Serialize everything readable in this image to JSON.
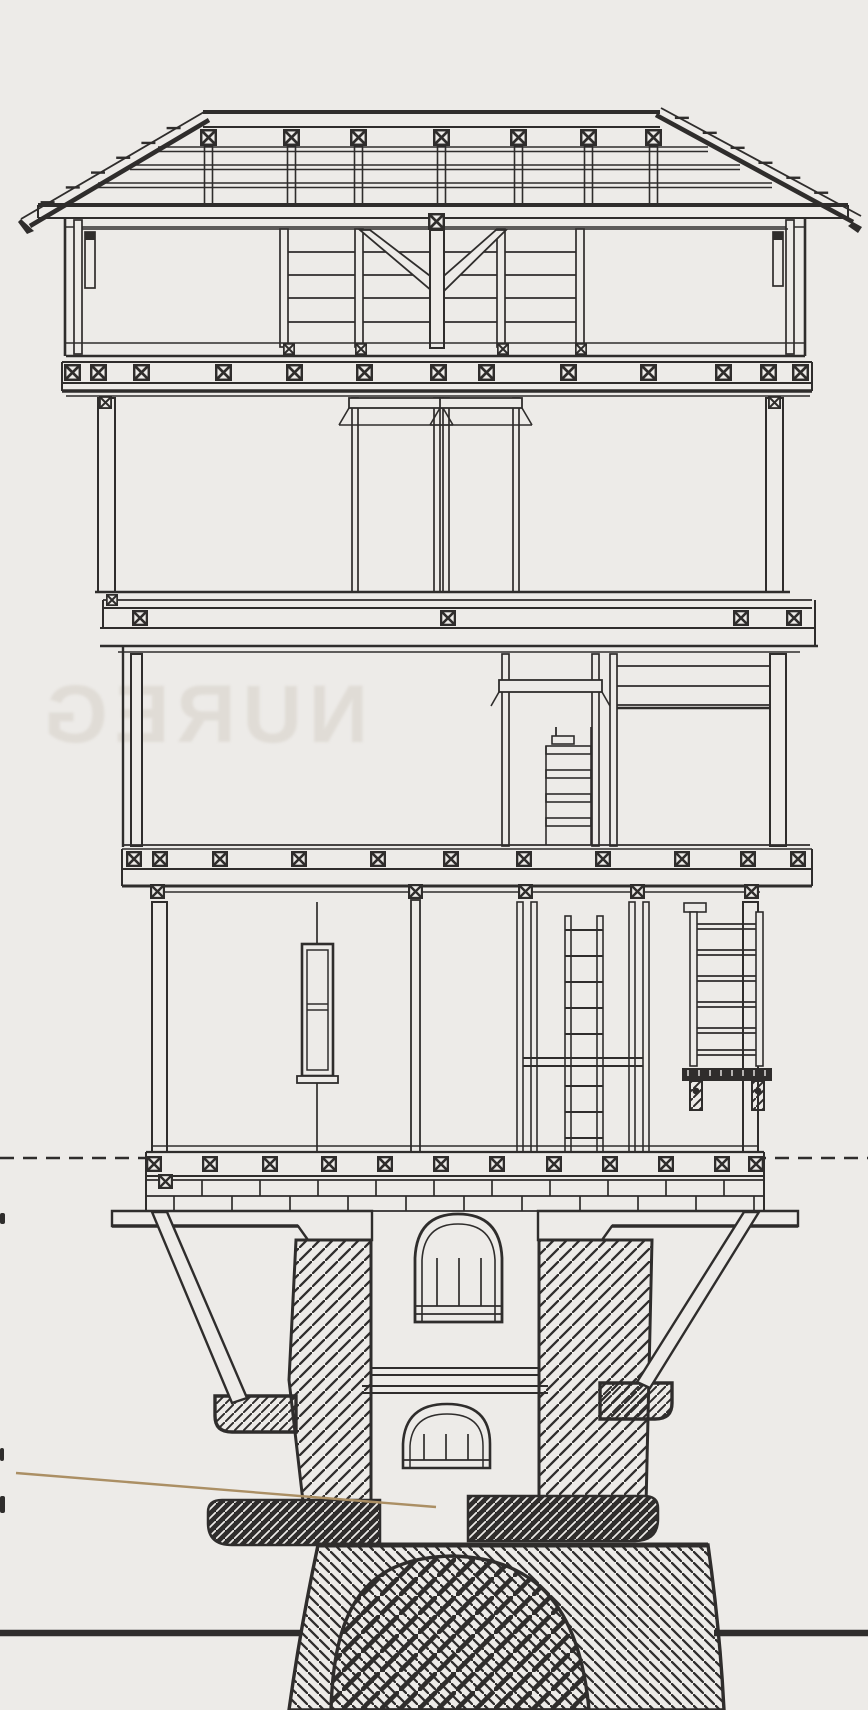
{
  "document": {
    "kind": "scanned architectural line drawing",
    "subject": "cross-section of a timber-framed tower on a hatched masonry base with arched foundation"
  },
  "watermark": {
    "text": "NUREG",
    "mirrored": true
  },
  "colors": {
    "paper": "#edebe8",
    "ink": "#2f2d2c",
    "leader_line": "#ab8f64",
    "watermark": "#e0dcd6"
  },
  "elements": [
    {
      "name": "roof",
      "label": "shingled gable roof with ridge beam and rafter X-blocks"
    },
    {
      "name": "attic-story",
      "label": "attic level with plank walls, V-braces and open side rooms"
    },
    {
      "name": "story-2",
      "label": "tall open story with two central post-and-lintel frames"
    },
    {
      "name": "story-3",
      "label": "story with central stair compartment and planked right wall"
    },
    {
      "name": "story-4",
      "label": "lowest timber story with window, ladder shaft and stair platform"
    },
    {
      "name": "masonry-base",
      "label": "hatched masonry piers with arched niches, corbels and diagonal struts"
    },
    {
      "name": "foundation",
      "label": "hatched foundation mass with large arch and ground line"
    },
    {
      "name": "datum-dashed-line",
      "label": "dashed level line at base of timber structure"
    },
    {
      "name": "leader-line",
      "label": "tan annotation leader line pointing into base shaft"
    }
  ]
}
